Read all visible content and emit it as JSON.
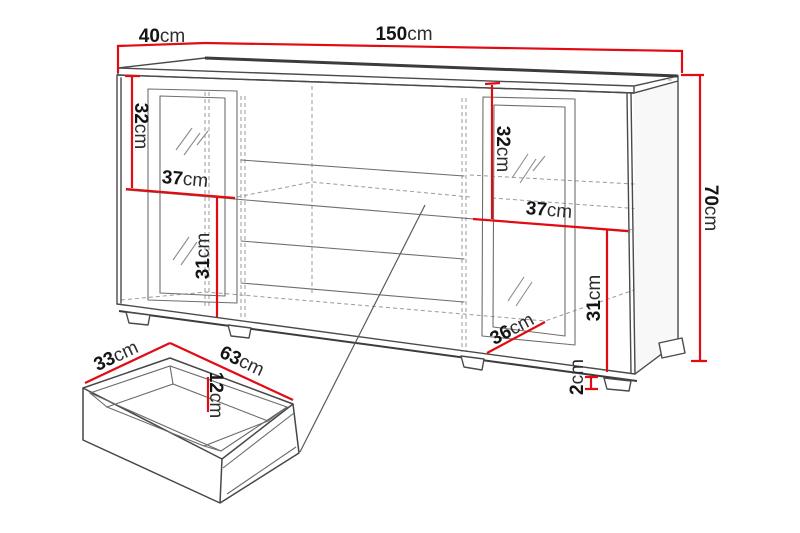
{
  "dims": {
    "cabinet": {
      "depth": {
        "value": "40",
        "unit": "cm"
      },
      "width": {
        "value": "150",
        "unit": "cm"
      },
      "height": {
        "value": "70",
        "unit": "cm"
      }
    },
    "left_section": {
      "upper_height": {
        "value": "32",
        "unit": "cm"
      },
      "shelf_width": {
        "value": "37",
        "unit": "cm"
      },
      "lower_height": {
        "value": "31",
        "unit": "cm"
      }
    },
    "right_section": {
      "upper_height": {
        "value": "32",
        "unit": "cm"
      },
      "shelf_width": {
        "value": "37",
        "unit": "cm"
      },
      "lower_height": {
        "value": "31",
        "unit": "cm"
      },
      "base_depth": {
        "value": "36",
        "unit": "cm"
      },
      "foot_height": {
        "value": "2",
        "unit": "cm"
      }
    },
    "drawer": {
      "width": {
        "value": "33",
        "unit": "cm"
      },
      "length": {
        "value": "63",
        "unit": "cm"
      },
      "height": {
        "value": "12",
        "unit": "cm"
      }
    }
  },
  "colors": {
    "dimension-red": "#e30b13",
    "line-gray": "#4a4a4a",
    "line-dark": "#3c3c3c",
    "dash-gray": "#9a9a9a",
    "text-dark": "#141414"
  }
}
